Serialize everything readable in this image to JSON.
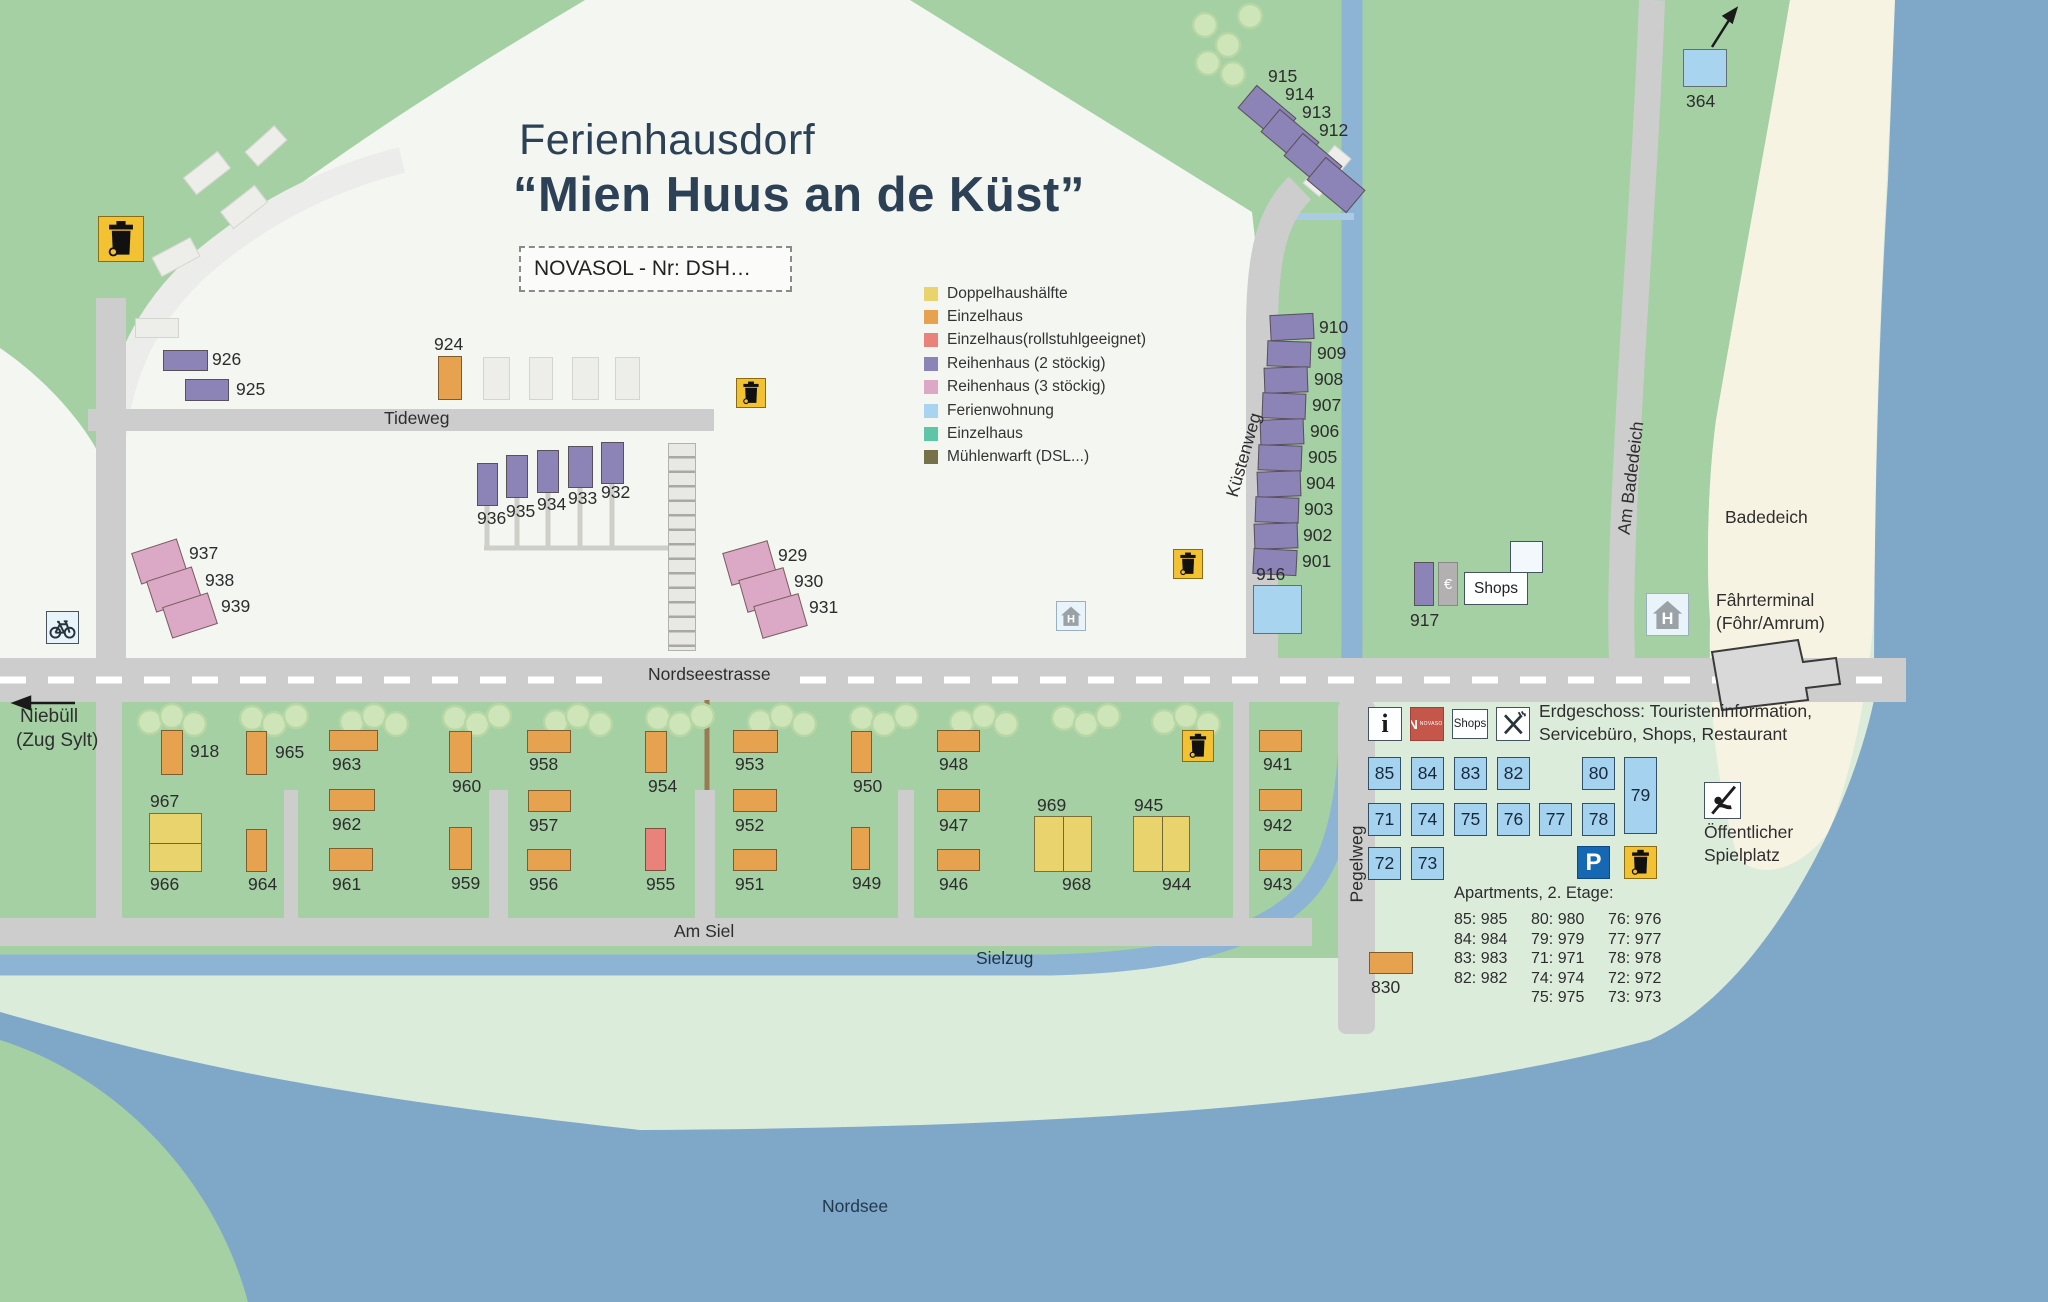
{
  "title": {
    "line1": "Ferienhausdorf",
    "line2": "“Mien Huus an de Küst”"
  },
  "subtitle_box": "NOVASOL - Nr: DSH…",
  "legend": {
    "items": [
      {
        "label": "Doppelhaushälfte",
        "color": "#e9d36c"
      },
      {
        "label": "Einzelhaus",
        "color": "#e7a24f"
      },
      {
        "label": "Einzelhaus(rollstuhlgeeignet)",
        "color": "#e8827b"
      },
      {
        "label": "Reihenhaus (2 stöckig)",
        "color": "#8c84b7"
      },
      {
        "label": "Reihenhaus (3 stöckig)",
        "color": "#dba8c5"
      },
      {
        "label": "Ferienwohnung",
        "color": "#a9d4f0"
      },
      {
        "label": "Einzelhaus",
        "color": "#5ec6a6"
      },
      {
        "label": "Mühlenwarft (DSL...)",
        "color": "#77714a"
      }
    ]
  },
  "colors": {
    "green": "#a4d0a4",
    "pale_green": "#dcecdb",
    "village": "#f3f6f1",
    "beach": "#f7f3e3",
    "sea": "#7ea7c8",
    "road": "#cdcdcd",
    "water": "#8db4d4",
    "trash_yellow": "#f2c233",
    "parking_blue": "#1668b3",
    "novasol_red": "#c4574a"
  },
  "houses": [
    {
      "n": "926",
      "t": "row2",
      "x": 163,
      "y": 350,
      "w": 45,
      "h": 21,
      "lx": 212,
      "ly": 349
    },
    {
      "n": "925",
      "t": "row2",
      "x": 185,
      "y": 379,
      "w": 44,
      "h": 22,
      "lx": 236,
      "ly": 379
    },
    {
      "n": "924",
      "t": "single",
      "x": 438,
      "y": 356,
      "w": 24,
      "h": 44,
      "lx": 434,
      "ly": 334
    },
    {
      "n": "936",
      "t": "row2",
      "x": 477,
      "y": 463,
      "w": 21,
      "h": 43,
      "lx": 477,
      "ly": 508
    },
    {
      "n": "935",
      "t": "row2",
      "x": 506,
      "y": 455,
      "w": 22,
      "h": 43,
      "lx": 506,
      "ly": 501
    },
    {
      "n": "934",
      "t": "row2",
      "x": 537,
      "y": 450,
      "w": 22,
      "h": 43,
      "lx": 537,
      "ly": 494
    },
    {
      "n": "933",
      "t": "row2",
      "x": 568,
      "y": 446,
      "w": 25,
      "h": 42,
      "lx": 568,
      "ly": 488
    },
    {
      "n": "932",
      "t": "row2",
      "x": 601,
      "y": 442,
      "w": 23,
      "h": 42,
      "lx": 601,
      "ly": 482
    },
    {
      "n": "937",
      "t": "row3",
      "x": 135,
      "y": 545,
      "w": 48,
      "h": 33,
      "r": -18,
      "lx": 189,
      "ly": 543
    },
    {
      "n": "938",
      "t": "row3",
      "x": 150,
      "y": 573,
      "w": 48,
      "h": 33,
      "r": -18,
      "lx": 205,
      "ly": 570
    },
    {
      "n": "939",
      "t": "row3",
      "x": 166,
      "y": 599,
      "w": 48,
      "h": 33,
      "r": -18,
      "lx": 221,
      "ly": 596
    },
    {
      "n": "929",
      "t": "row3",
      "x": 726,
      "y": 546,
      "w": 47,
      "h": 34,
      "r": -16,
      "lx": 778,
      "ly": 545
    },
    {
      "n": "930",
      "t": "row3",
      "x": 742,
      "y": 573,
      "w": 47,
      "h": 34,
      "r": -16,
      "lx": 794,
      "ly": 571
    },
    {
      "n": "931",
      "t": "row3",
      "x": 757,
      "y": 599,
      "w": 47,
      "h": 34,
      "r": -16,
      "lx": 809,
      "ly": 597
    },
    {
      "n": "915",
      "t": "row2",
      "x": 1241,
      "y": 98,
      "w": 52,
      "h": 30,
      "r": 40,
      "lx": 1268,
      "ly": 66
    },
    {
      "n": "914",
      "t": "row2",
      "x": 1264,
      "y": 122,
      "w": 52,
      "h": 30,
      "r": 40,
      "lx": 1285,
      "ly": 84
    },
    {
      "n": "913",
      "t": "row2",
      "x": 1287,
      "y": 146,
      "w": 52,
      "h": 30,
      "r": 40,
      "lx": 1302,
      "ly": 102
    },
    {
      "n": "912",
      "t": "row2",
      "x": 1310,
      "y": 170,
      "w": 52,
      "h": 30,
      "r": 40,
      "lx": 1319,
      "ly": 120
    },
    {
      "n": "910",
      "t": "row2",
      "x": 1270,
      "y": 314,
      "w": 44,
      "h": 26,
      "r": -3,
      "lx": 1319,
      "ly": 317
    },
    {
      "n": "909",
      "t": "row2",
      "x": 1267,
      "y": 341,
      "w": 44,
      "h": 26,
      "r": 2,
      "lx": 1317,
      "ly": 343
    },
    {
      "n": "908",
      "t": "row2",
      "x": 1264,
      "y": 367,
      "w": 44,
      "h": 26,
      "r": -2,
      "lx": 1314,
      "ly": 369
    },
    {
      "n": "907",
      "t": "row2",
      "x": 1262,
      "y": 393,
      "w": 44,
      "h": 26,
      "r": 2,
      "lx": 1312,
      "ly": 395
    },
    {
      "n": "906",
      "t": "row2",
      "x": 1260,
      "y": 419,
      "w": 44,
      "h": 26,
      "r": -2,
      "lx": 1310,
      "ly": 421
    },
    {
      "n": "905",
      "t": "row2",
      "x": 1258,
      "y": 445,
      "w": 44,
      "h": 26,
      "r": 2,
      "lx": 1308,
      "ly": 447
    },
    {
      "n": "904",
      "t": "row2",
      "x": 1257,
      "y": 471,
      "w": 44,
      "h": 26,
      "r": -2,
      "lx": 1306,
      "ly": 473
    },
    {
      "n": "903",
      "t": "row2",
      "x": 1255,
      "y": 497,
      "w": 44,
      "h": 26,
      "r": 2,
      "lx": 1304,
      "ly": 499
    },
    {
      "n": "902",
      "t": "row2",
      "x": 1254,
      "y": 523,
      "w": 44,
      "h": 26,
      "r": -2,
      "lx": 1303,
      "ly": 525
    },
    {
      "n": "901",
      "t": "row2",
      "x": 1253,
      "y": 549,
      "w": 44,
      "h": 26,
      "r": 3,
      "lx": 1302,
      "ly": 551
    },
    {
      "n": "916",
      "t": "flat",
      "x": 1253,
      "y": 585,
      "w": 49,
      "h": 49,
      "lx": 1256,
      "ly": 564
    },
    {
      "n": "917",
      "t": "row2",
      "x": 1414,
      "y": 562,
      "w": 20,
      "h": 44,
      "lx": 1410,
      "ly": 610
    },
    {
      "n": "364",
      "t": "flat",
      "x": 1683,
      "y": 49,
      "w": 44,
      "h": 38,
      "lx": 1686,
      "ly": 91
    },
    {
      "n": "830",
      "t": "single",
      "x": 1369,
      "y": 952,
      "w": 44,
      "h": 22,
      "lx": 1371,
      "ly": 977
    },
    {
      "n": "918",
      "t": "single",
      "x": 161,
      "y": 730,
      "w": 22,
      "h": 45,
      "lx": 190,
      "ly": 741
    },
    {
      "n": "965",
      "t": "single",
      "x": 246,
      "y": 731,
      "w": 21,
      "h": 44,
      "lx": 275,
      "ly": 742
    },
    {
      "n": "963",
      "t": "single",
      "x": 329,
      "y": 730,
      "w": 49,
      "h": 21,
      "lx": 332,
      "ly": 754
    },
    {
      "n": "962",
      "t": "single",
      "x": 329,
      "y": 789,
      "w": 46,
      "h": 22,
      "lx": 332,
      "ly": 814
    },
    {
      "n": "961",
      "t": "single",
      "x": 329,
      "y": 848,
      "w": 44,
      "h": 23,
      "lx": 332,
      "ly": 874
    },
    {
      "n": "964",
      "t": "single",
      "x": 246,
      "y": 829,
      "w": 21,
      "h": 43,
      "lx": 248,
      "ly": 874
    },
    {
      "n": "967",
      "n2": "966",
      "t": "double",
      "split": "h",
      "x": 149,
      "y": 813,
      "w": 53,
      "h": 59,
      "lx": 150,
      "ly": 791,
      "lx2": 150,
      "ly2": 874
    },
    {
      "n": "960",
      "t": "single",
      "x": 449,
      "y": 731,
      "w": 23,
      "h": 42,
      "lx": 452,
      "ly": 776
    },
    {
      "n": "958",
      "t": "single",
      "x": 527,
      "y": 730,
      "w": 44,
      "h": 23,
      "lx": 529,
      "ly": 754
    },
    {
      "n": "957",
      "t": "single",
      "x": 528,
      "y": 790,
      "w": 43,
      "h": 22,
      "lx": 529,
      "ly": 815
    },
    {
      "n": "959",
      "t": "single",
      "x": 449,
      "y": 827,
      "w": 23,
      "h": 43,
      "lx": 451,
      "ly": 873
    },
    {
      "n": "956",
      "t": "single",
      "x": 527,
      "y": 849,
      "w": 44,
      "h": 22,
      "lx": 529,
      "ly": 874
    },
    {
      "n": "954",
      "t": "single",
      "x": 645,
      "y": 731,
      "w": 22,
      "h": 42,
      "lx": 648,
      "ly": 776
    },
    {
      "n": "955",
      "t": "wheel",
      "x": 645,
      "y": 828,
      "w": 21,
      "h": 43,
      "lx": 646,
      "ly": 874
    },
    {
      "n": "953",
      "t": "single",
      "x": 733,
      "y": 730,
      "w": 45,
      "h": 23,
      "lx": 735,
      "ly": 754
    },
    {
      "n": "952",
      "t": "single",
      "x": 733,
      "y": 789,
      "w": 44,
      "h": 23,
      "lx": 735,
      "ly": 815
    },
    {
      "n": "951",
      "t": "single",
      "x": 733,
      "y": 849,
      "w": 44,
      "h": 22,
      "lx": 735,
      "ly": 874
    },
    {
      "n": "950",
      "t": "single",
      "x": 851,
      "y": 731,
      "w": 21,
      "h": 42,
      "lx": 853,
      "ly": 776
    },
    {
      "n": "949",
      "t": "single",
      "x": 851,
      "y": 827,
      "w": 19,
      "h": 43,
      "lx": 852,
      "ly": 873
    },
    {
      "n": "948",
      "t": "single",
      "x": 937,
      "y": 730,
      "w": 43,
      "h": 22,
      "lx": 939,
      "ly": 754
    },
    {
      "n": "947",
      "t": "single",
      "x": 937,
      "y": 789,
      "w": 43,
      "h": 23,
      "lx": 939,
      "ly": 815
    },
    {
      "n": "946",
      "t": "single",
      "x": 937,
      "y": 849,
      "w": 43,
      "h": 22,
      "lx": 939,
      "ly": 874
    },
    {
      "n": "969",
      "n2": "968",
      "t": "double",
      "split": "v",
      "x": 1034,
      "y": 816,
      "w": 58,
      "h": 56,
      "lx": 1037,
      "ly": 795,
      "lx2": 1062,
      "ly2": 874
    },
    {
      "n": "945",
      "n2": "944",
      "t": "double",
      "split": "v",
      "x": 1133,
      "y": 816,
      "w": 57,
      "h": 56,
      "lx": 1134,
      "ly": 795,
      "lx2": 1162,
      "ly2": 874
    },
    {
      "n": "941",
      "t": "single",
      "x": 1259,
      "y": 730,
      "w": 43,
      "h": 22,
      "lx": 1263,
      "ly": 754
    },
    {
      "n": "942",
      "t": "single",
      "x": 1259,
      "y": 789,
      "w": 43,
      "h": 22,
      "lx": 1263,
      "ly": 815
    },
    {
      "n": "943",
      "t": "single",
      "x": 1259,
      "y": 849,
      "w": 43,
      "h": 22,
      "lx": 1263,
      "ly": 874
    }
  ],
  "labels": [
    {
      "t": "Tideweg",
      "x": 384,
      "y": 407,
      "size": 17.5
    },
    {
      "t": "Nordseestrasse",
      "x": 648,
      "y": 663,
      "size": 17.5
    },
    {
      "t": "Am Siel",
      "x": 674,
      "y": 920,
      "size": 17.5
    },
    {
      "t": "Sielzug",
      "x": 976,
      "y": 947,
      "size": 17.5,
      "color": "#1c3347"
    },
    {
      "t": "Nordsee",
      "x": 822,
      "y": 1195,
      "size": 17.5,
      "color": "#22394e"
    },
    {
      "t": "Badedeich",
      "x": 1725,
      "y": 506,
      "size": 17.5
    },
    {
      "t": "Fâhrterminal\n(Fôhr/Amrum)",
      "x": 1716,
      "y": 589,
      "size": 17.5
    },
    {
      "t": "Küstenweg",
      "cx": 1244,
      "cy": 455,
      "rot": -74,
      "size": 17.5
    },
    {
      "t": "Am Badedeich",
      "cx": 1631,
      "cy": 478,
      "rot": -83,
      "size": 17.5
    },
    {
      "t": "Pegelweg",
      "cx": 1357,
      "cy": 864,
      "rot": -90,
      "size": 17.5
    },
    {
      "t": "Niebüll",
      "x": 20,
      "y": 704,
      "size": 19
    },
    {
      "t": "(Zug Sylt)",
      "x": 16,
      "y": 728,
      "size": 19
    },
    {
      "t": "Erdgeschoss: Touristeninformation,\nServicebüro, Shops, Restaurant",
      "x": 1539,
      "y": 700,
      "size": 17.5
    },
    {
      "t": "Öffentlicher\nSpielplatz",
      "x": 1704,
      "y": 821,
      "size": 17.5
    }
  ],
  "icons": [
    {
      "t": "trash",
      "x": 98,
      "y": 216,
      "w": 46,
      "h": 46
    },
    {
      "t": "trash",
      "x": 736,
      "y": 378,
      "w": 30,
      "h": 30
    },
    {
      "t": "trash",
      "x": 1173,
      "y": 549,
      "w": 30,
      "h": 30
    },
    {
      "t": "trash",
      "x": 1182,
      "y": 730,
      "w": 32,
      "h": 32
    },
    {
      "t": "trash",
      "x": 1624,
      "y": 846,
      "w": 33,
      "h": 33
    },
    {
      "t": "hstop",
      "x": 1056,
      "y": 601,
      "w": 30,
      "h": 30,
      "label": "H"
    },
    {
      "t": "hstop",
      "x": 1646,
      "y": 593,
      "w": 43,
      "h": 43,
      "label": "H"
    },
    {
      "t": "bike",
      "x": 46,
      "y": 611,
      "w": 33,
      "h": 33
    },
    {
      "t": "park",
      "x": 1577,
      "y": 846,
      "w": 33,
      "h": 33,
      "label": "P"
    },
    {
      "t": "play",
      "x": 1704,
      "y": 782,
      "w": 37,
      "h": 37
    },
    {
      "t": "info",
      "x": 1368,
      "y": 707,
      "w": 34,
      "h": 34,
      "label": "i"
    },
    {
      "t": "nova",
      "x": 1410,
      "y": 707,
      "w": 34,
      "h": 34,
      "label": "N",
      "label2": "NOVASOL"
    },
    {
      "t": "shopbox",
      "x": 1452,
      "y": 709,
      "w": 36,
      "h": 30,
      "label": "Shops",
      "fs": 11.5
    },
    {
      "t": "rest",
      "x": 1496,
      "y": 707,
      "w": 34,
      "h": 34
    },
    {
      "t": "euro",
      "x": 1438,
      "y": 562,
      "w": 20,
      "h": 44,
      "label": "€"
    },
    {
      "t": "shopbox",
      "x": 1464,
      "y": 572,
      "w": 64,
      "h": 33,
      "label": "Shops",
      "fs": 15.5
    },
    {
      "t": "whitebox",
      "x": 1510,
      "y": 541,
      "w": 33,
      "h": 32
    }
  ],
  "apartments": {
    "heading": "Apartments, 2. Etage:",
    "columns": [
      [
        "85: 985",
        "84: 984",
        "83: 983",
        "82: 982"
      ],
      [
        "80: 980",
        "79: 979",
        "71: 971",
        "74: 974",
        "75: 975"
      ],
      [
        "76: 976",
        "77: 977",
        "78: 978",
        "72: 972",
        "73: 973"
      ]
    ],
    "units": [
      {
        "n": "85",
        "x": 1368,
        "y": 757,
        "w": 33,
        "h": 33
      },
      {
        "n": "84",
        "x": 1411,
        "y": 757,
        "w": 33,
        "h": 33
      },
      {
        "n": "83",
        "x": 1454,
        "y": 757,
        "w": 33,
        "h": 33
      },
      {
        "n": "82",
        "x": 1497,
        "y": 757,
        "w": 33,
        "h": 33
      },
      {
        "n": "80",
        "x": 1582,
        "y": 757,
        "w": 33,
        "h": 33
      },
      {
        "n": "79",
        "x": 1624,
        "y": 757,
        "w": 33,
        "h": 77
      },
      {
        "n": "71",
        "x": 1368,
        "y": 803,
        "w": 33,
        "h": 33
      },
      {
        "n": "74",
        "x": 1411,
        "y": 803,
        "w": 33,
        "h": 33
      },
      {
        "n": "75",
        "x": 1454,
        "y": 803,
        "w": 33,
        "h": 33
      },
      {
        "n": "76",
        "x": 1497,
        "y": 803,
        "w": 33,
        "h": 33
      },
      {
        "n": "77",
        "x": 1539,
        "y": 803,
        "w": 33,
        "h": 33
      },
      {
        "n": "78",
        "x": 1582,
        "y": 803,
        "w": 33,
        "h": 33
      },
      {
        "n": "72",
        "x": 1368,
        "y": 847,
        "w": 33,
        "h": 33
      },
      {
        "n": "73",
        "x": 1411,
        "y": 847,
        "w": 33,
        "h": 33
      }
    ]
  }
}
